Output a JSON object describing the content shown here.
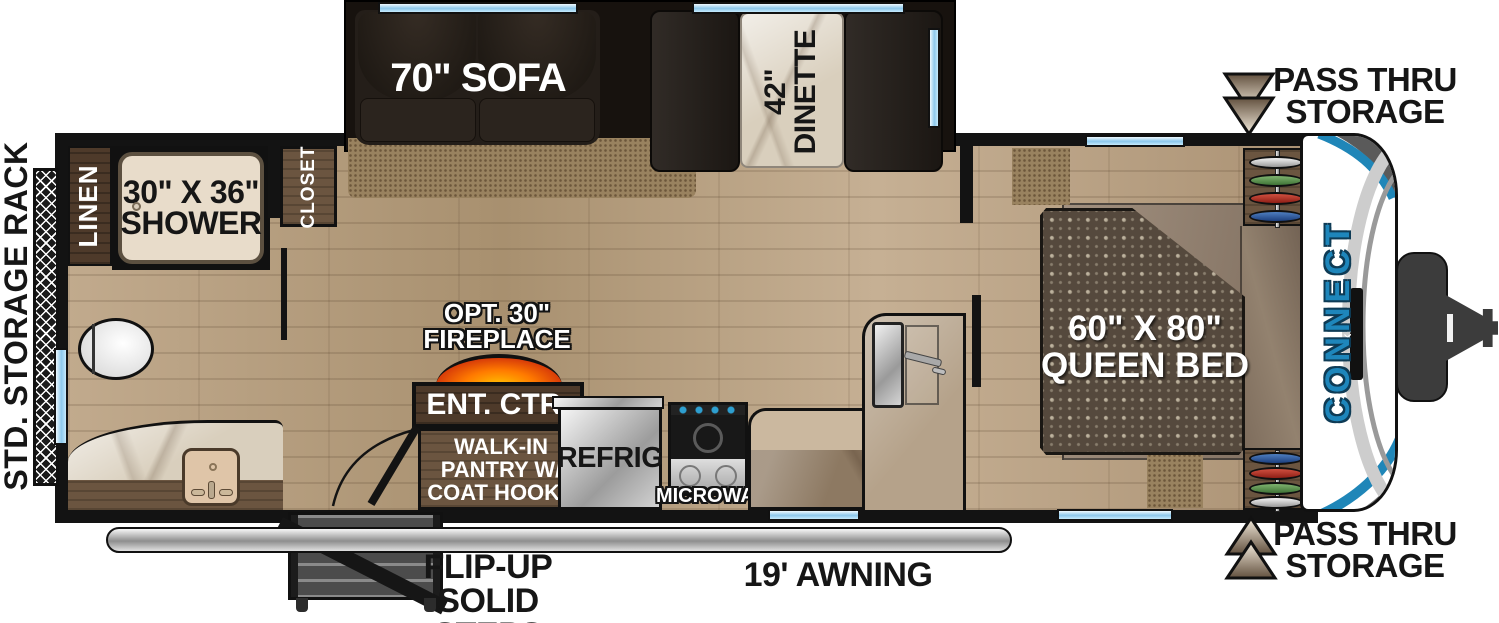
{
  "title": "CONNECT travel trailer floorplan",
  "brand": {
    "name": "CONNECT",
    "badge": "KZ"
  },
  "colors": {
    "accent_blue": "#1e86bb",
    "window_blue": "#9fd4f0",
    "wall_black": "#131313",
    "fireplace_orange": "#ff7a00"
  },
  "exterior": {
    "storage_rack": "STD. STORAGE RACK",
    "pass_thru_top": {
      "line1": "PASS THRU",
      "line2": "STORAGE"
    },
    "pass_thru_bottom": {
      "line1": "PASS THRU",
      "line2": "STORAGE"
    },
    "steps": {
      "line1": "FLIP-UP",
      "line2": "SOLID STEPS"
    },
    "awning": "19' AWNING"
  },
  "interior": {
    "sofa": "70\" SOFA",
    "dinette": {
      "line1": "42\"",
      "line2": "DINETTE"
    },
    "linen": "LINEN",
    "shower": {
      "line1": "30\" X 36\"",
      "line2": "SHOWER"
    },
    "closet": "CLOSET",
    "fireplace": {
      "line1": "OPT. 30\"",
      "line2": "FIREPLACE"
    },
    "ent_ctr": "ENT. CTR.",
    "pantry": {
      "line1": "WALK-IN",
      "line2": "PANTRY W/",
      "line3": "COAT HOOKS"
    },
    "refrig": "REFRIG",
    "microwave": "MICROWAVE",
    "queen_bed": {
      "line1": "60\" X 80\"",
      "line2": "QUEEN BED"
    }
  }
}
